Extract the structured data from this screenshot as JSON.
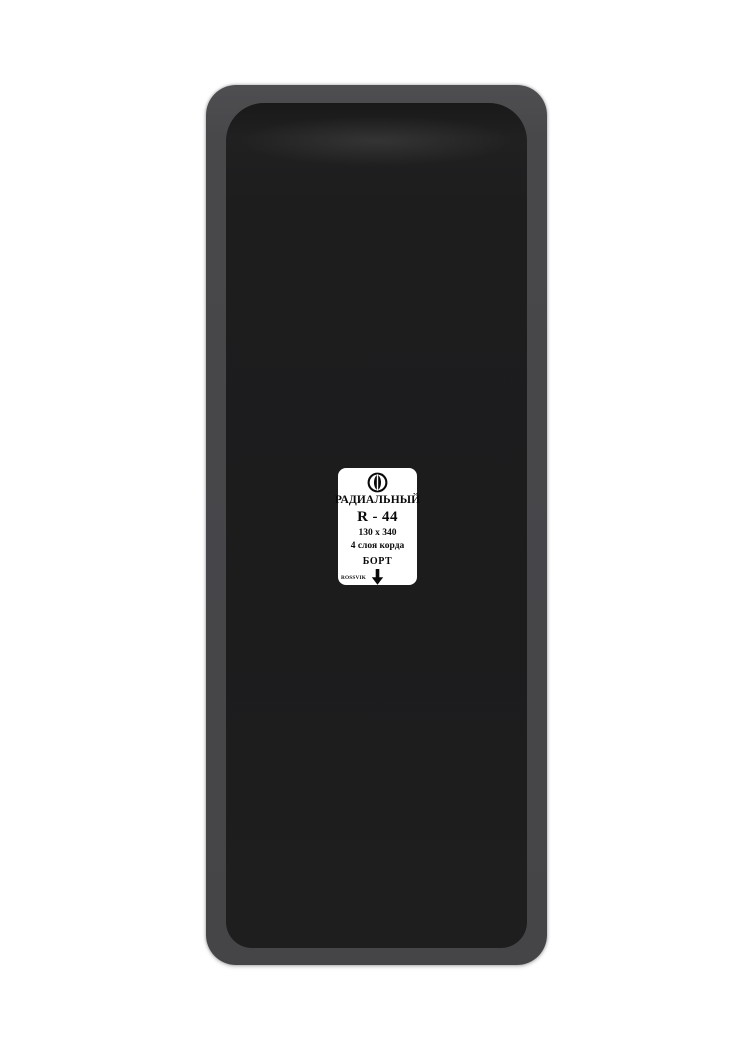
{
  "product_label": {
    "type": "РАДИАЛЬНЫЙ",
    "model": "R - 44",
    "size": "130 x 340",
    "cord_plies": "4 слоя корда",
    "bead": "БОРТ",
    "brand": "ROSSVIK"
  },
  "icons": {
    "logo": "rossvik-logo-icon",
    "bead_arrow": "down-arrow-icon"
  },
  "colors": {
    "bg": "#ffffff",
    "patch_edge": "#48484b",
    "patch_face": "#1d1d1e",
    "label_bg": "#ffffff",
    "label_text": "#0a0a0a"
  }
}
